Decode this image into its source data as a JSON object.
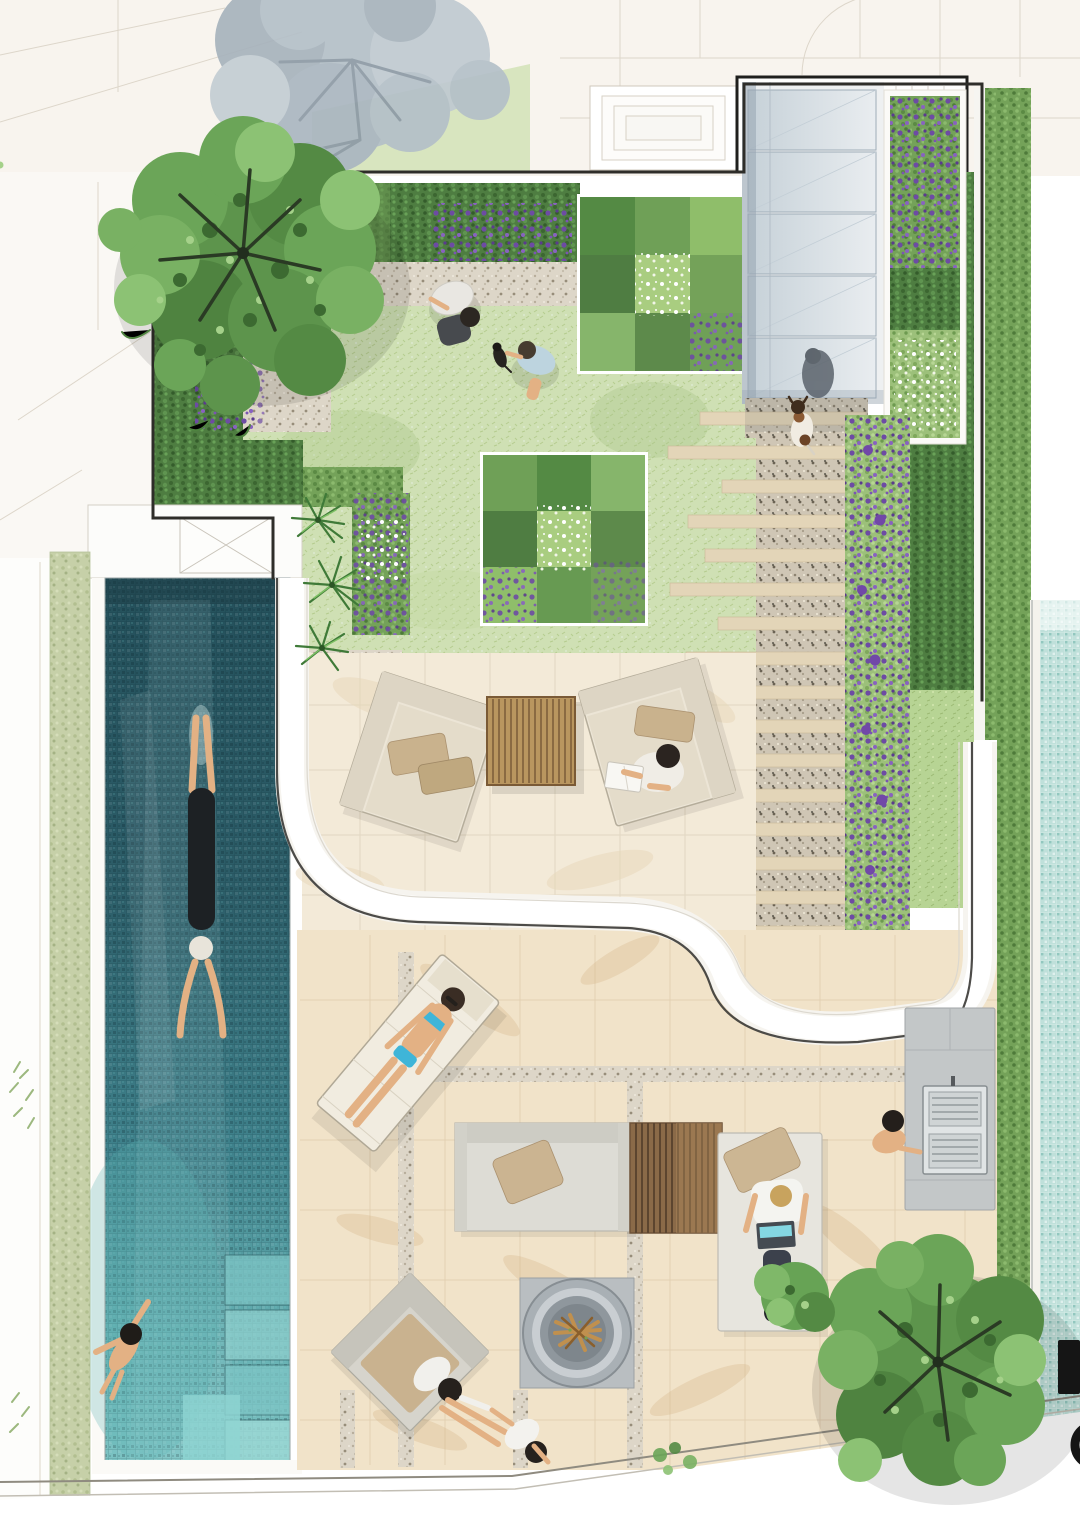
{
  "scene": {
    "title": "Residential landscape masterplan — top-down watercolour render",
    "type": "landscape-architecture-site-plan",
    "view": "plan"
  },
  "palette": {
    "pool_deep": "#24505b",
    "pool_mid": "#3f828c",
    "pool_shallow": "#7cc3c3",
    "neighbor_pool": "#bfe0da",
    "lawn": "#cfe0b4",
    "lawn_bright": "#b7d494",
    "hedge_dark": "#4e7d41",
    "hedge_mid": "#74a259",
    "hedge_light": "#9cc07a",
    "sage_hedge": "#c6d0a8",
    "purple_bloom": "#6d4ba4",
    "white_bloom": "#f6f9ef",
    "paving_warm": "#f3ead8",
    "paving_lower": "#f1e3c9",
    "paving_vein": "#d8b88e",
    "gravel": "#ddd6c8",
    "gravel_dark": "#cfc6b5",
    "timber_plank": "#e3d5b8",
    "timber_table": "#b9965f",
    "timber_slats": "#8a6a48",
    "glass_canopy": "#d7dee4",
    "wall_white": "#ffffff",
    "boundary_line": "#2e2d29",
    "grey_tree": "#b2bdc6",
    "tree_green": "#5d944c",
    "furniture_grey": "#dddcd5",
    "cushion_tan": "#cbb491",
    "skin": "#e3b184",
    "bikini_blue": "#3fb5d8",
    "laptop_screen": "#84d7e2",
    "bbq_steel": "#e0e4e5",
    "fire_ring": "#aab1b6",
    "log_wood": "#c79a5c"
  },
  "elements": {
    "canvas": {
      "label": "Landscape site plan, top-down watercolour render"
    },
    "pool": {
      "label": "Swimming pool with mosaic finish"
    },
    "swimmer": {
      "label": "Swimmer doing laps"
    },
    "bather": {
      "label": "Bather near pool steps"
    },
    "pool_steps": {
      "label": "Pool entry steps"
    },
    "lawn": {
      "label": "Lawn"
    },
    "tree_nw": {
      "label": "Feature tree (north-west corner)"
    },
    "tree_se": {
      "label": "Feature tree (south-east corner)"
    },
    "neighbor_tree": {
      "label": "Neighbouring tree shown in grey"
    },
    "canopy": {
      "label": "Glazed entry canopy"
    },
    "canopy_person": {
      "label": "Person beneath canopy"
    },
    "canopy_bed": {
      "label": "Planter with purple perennials"
    },
    "steppers": {
      "label": "Timber stepper path over gravel"
    },
    "agapanthus": {
      "label": "Purple flowering border"
    },
    "island": {
      "label": "Clipped hedge island bed"
    },
    "checkerboard": {
      "label": "Checkerboard hedge parterre"
    },
    "hedge_band": {
      "label": "Clipped hedge border"
    },
    "palm_cluster": {
      "label": "Palm planting beside pool"
    },
    "terrace_upper": {
      "label": "Upper stone terrace"
    },
    "terrace_lower": {
      "label": "Lower stone terrace"
    },
    "wall": {
      "label": "Curved white retaining wall"
    },
    "armchair_left": {
      "label": "Outdoor armchair"
    },
    "armchair_right": {
      "label": "Outdoor armchair with person reading"
    },
    "coffee_table": {
      "label": "Slatted timber coffee table"
    },
    "lounger": {
      "label": "Sun lounger with sunbather"
    },
    "sofa": {
      "label": "Outdoor sofa"
    },
    "slat_table": {
      "label": "Slatted timber low table"
    },
    "daybed": {
      "label": "Daybed with person using laptop"
    },
    "bbq": {
      "label": "Barbecue station with cook"
    },
    "firepit": {
      "label": "Round fire pit"
    },
    "chair_sw": {
      "label": "Lounge chair by fire pit"
    },
    "people_fire": {
      "label": "Two people beside the fire pit"
    },
    "gardeners": {
      "label": "People planting on the lawn with puppy"
    },
    "dog": {
      "label": "Dog on the stepper path"
    },
    "hedge_left": {
      "label": "Western boundary hedge"
    },
    "hedge_right": {
      "label": "Eastern boundary hedge"
    },
    "neighbor_pool": {
      "label": "Neighbouring pool strip"
    },
    "building": {
      "label": "Adjacent building footprint"
    },
    "steps_structure": {
      "label": "External steps outside boundary"
    },
    "boundary": {
      "label": "Site boundary wall"
    },
    "marks": {
      "label": "Cropped dark markings at sheet edge"
    }
  }
}
